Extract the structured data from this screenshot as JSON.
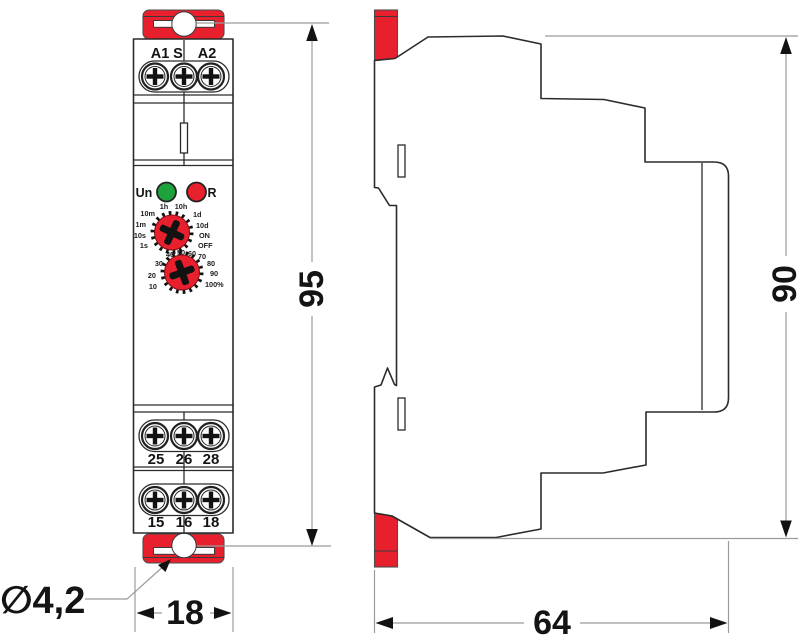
{
  "front_view": {
    "top_terminal_labels": [
      "A1",
      "S",
      "A2"
    ],
    "led_un_label": "Un",
    "led_r_label": "R",
    "time_dial_labels": [
      "1h",
      "10h",
      "10m",
      "1m",
      "10s",
      "1s",
      "1d",
      "10d",
      "ON",
      "OFF"
    ],
    "percent_dial_labels": [
      "40",
      "50",
      "60",
      "70",
      "30",
      "80",
      "20",
      "90",
      "10",
      "100%"
    ],
    "mid_terminal_labels": [
      "25",
      "26",
      "28"
    ],
    "bottom_terminal_labels": [
      "15",
      "16",
      "18"
    ]
  },
  "dimensions": {
    "front_height": "95",
    "side_height": "90",
    "front_width": "18",
    "side_depth": "64",
    "hole_diameter": "∅4,2"
  },
  "colors": {
    "accent_red": "#e8202d",
    "led_green": "#1ea33c"
  }
}
